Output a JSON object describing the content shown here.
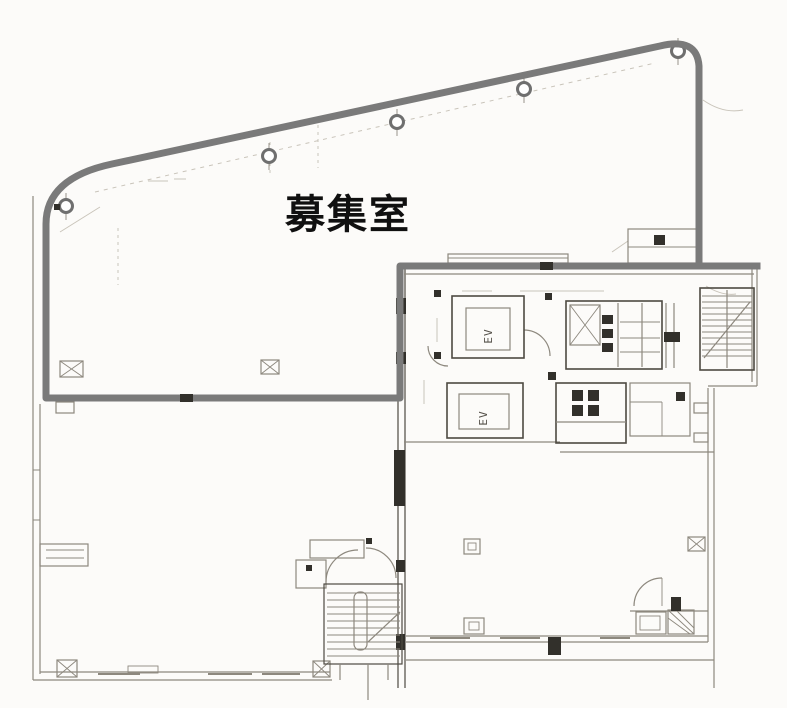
{
  "window": {
    "width": 787,
    "height": 708
  },
  "floorplan": {
    "room_label": "募集室",
    "elevators": [
      {
        "label": "EV"
      },
      {
        "label": "EV"
      }
    ],
    "colors": {
      "background": "#fcfbf9",
      "boundary": "#7a7a7a",
      "thin_line": "#8d887e",
      "dark_line": "#4e4a42",
      "fixture_fill": "#32302b",
      "faint_line": "#c9c4ba",
      "label_color": "#101010"
    }
  }
}
